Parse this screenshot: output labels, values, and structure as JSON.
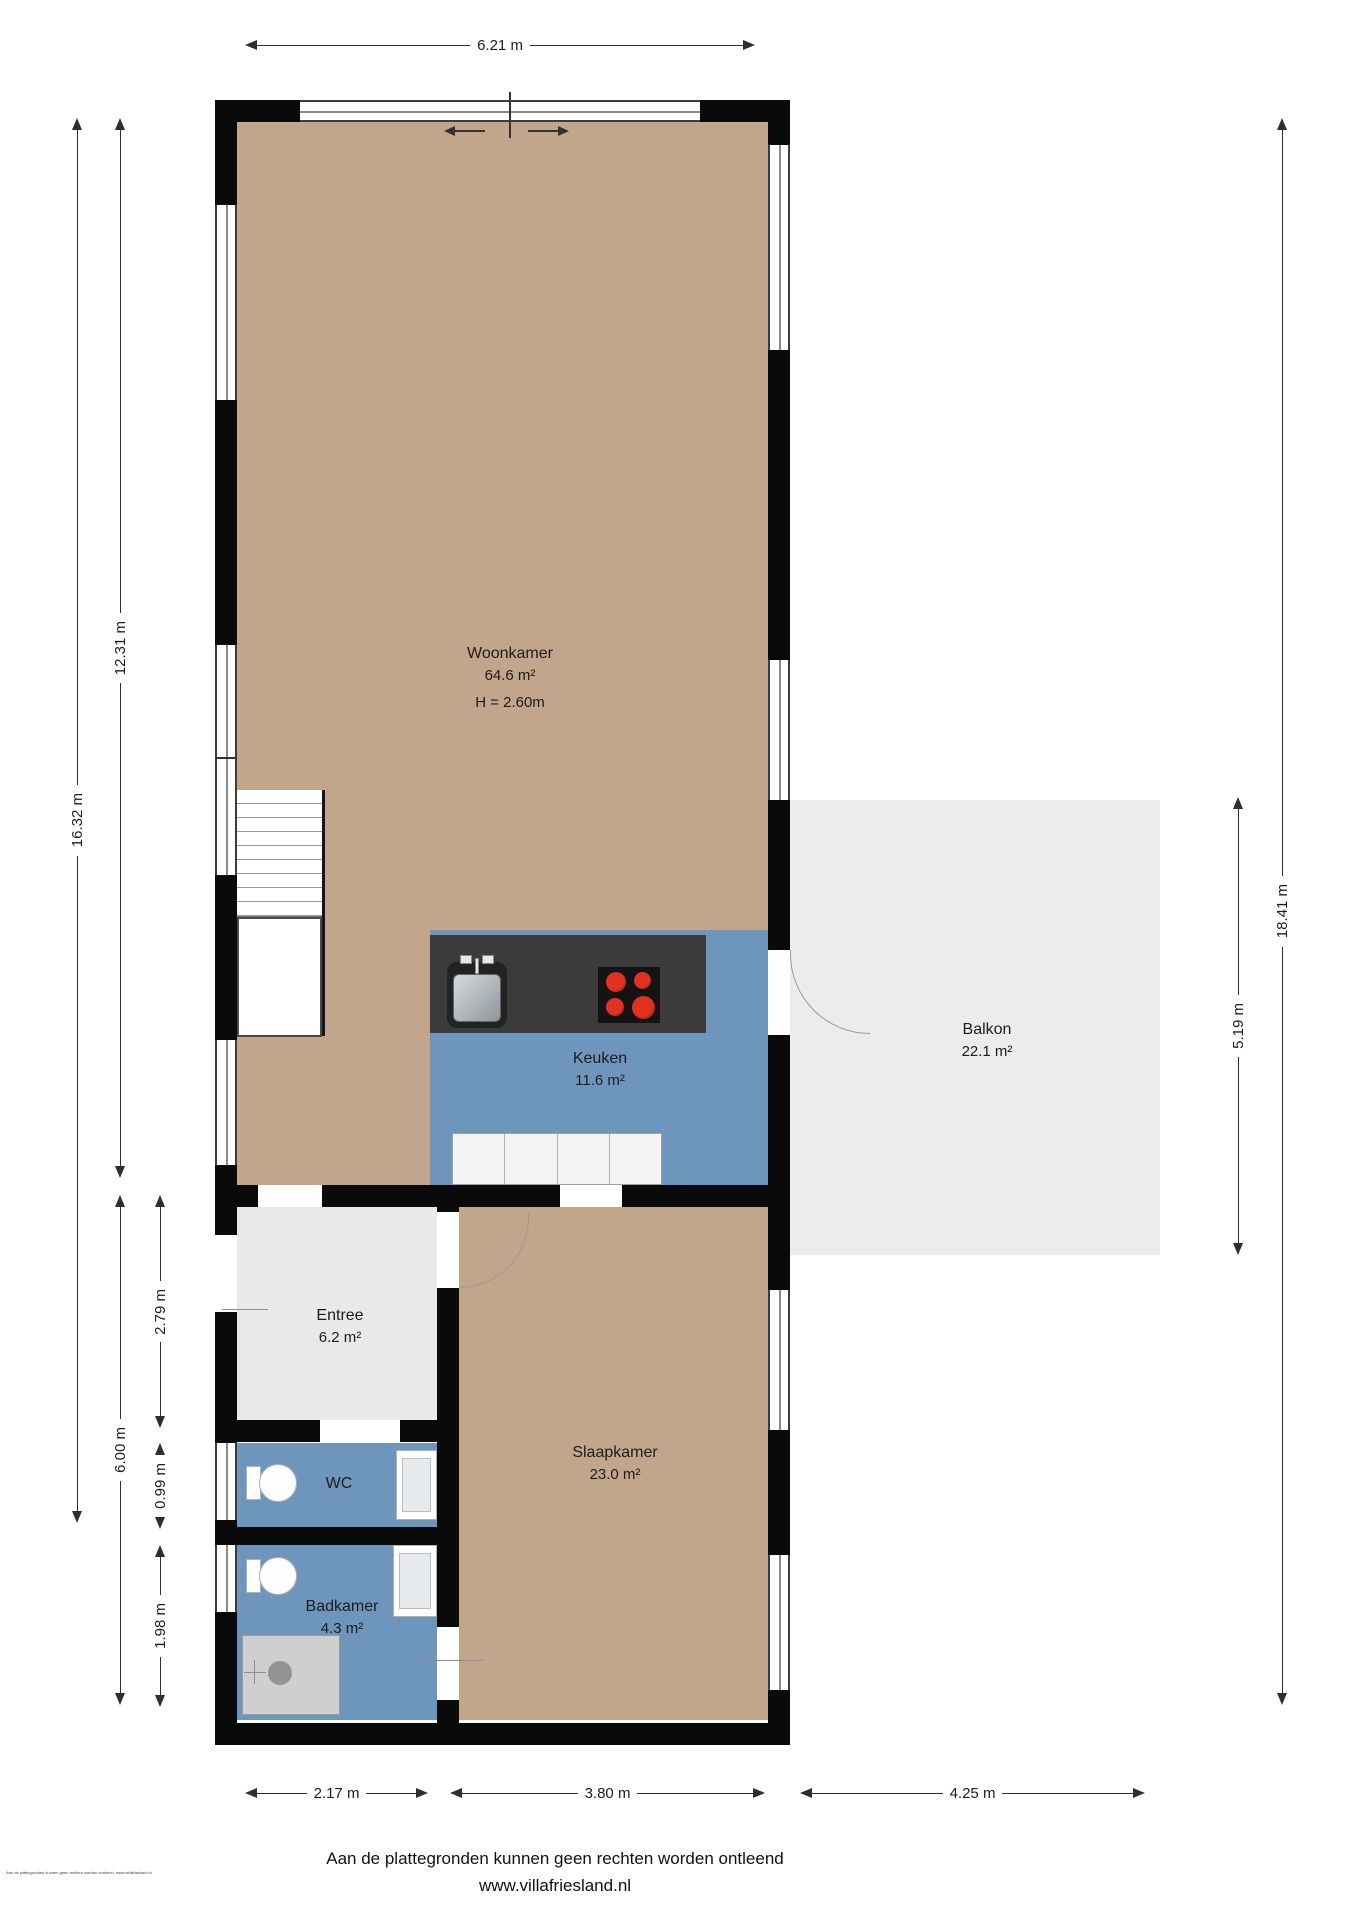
{
  "rooms": {
    "woonkamer": {
      "name": "Woonkamer",
      "area": "64.6 m²",
      "height": "H = 2.60m"
    },
    "keuken": {
      "name": "Keuken",
      "area": "11.6 m²"
    },
    "balkon": {
      "name": "Balkon",
      "area": "22.1 m²"
    },
    "entree": {
      "name": "Entree",
      "area": "6.2 m²"
    },
    "wc": {
      "name": "WC"
    },
    "badkamer": {
      "name": "Badkamer",
      "area": "4.3 m²"
    },
    "slaapkamer": {
      "name": "Slaapkamer",
      "area": "23.0 m²"
    }
  },
  "dimensions": {
    "top_width": "6.21 m",
    "left_total": "16.32 m",
    "left_upper": "12.31 m",
    "left_lower": "6.00 m",
    "left_entree": "2.79 m",
    "left_wc": "0.99 m",
    "left_badkamer": "1.98 m",
    "right_total": "18.41 m",
    "right_balkon": "5.19 m",
    "bottom_left": "2.17 m",
    "bottom_middle": "3.80 m",
    "bottom_right": "4.25 m"
  },
  "footer": {
    "disclaimer": "Aan de plattegronden kunnen geen rechten worden ontleend",
    "website": "www.villafriesland.nl"
  },
  "watermark": "Aan de plattegronden kunnen geen rechten worden ontleend. www.villafriesland.nl",
  "colors": {
    "floor_wood": "#c2a68b",
    "floor_wet": "#6e96bd",
    "floor_entree": "#e9e9e9",
    "balkon": "#ececec",
    "wall": "#0a0a0a",
    "counter": "#3b3b3b",
    "burner_red": "#d0261b"
  }
}
